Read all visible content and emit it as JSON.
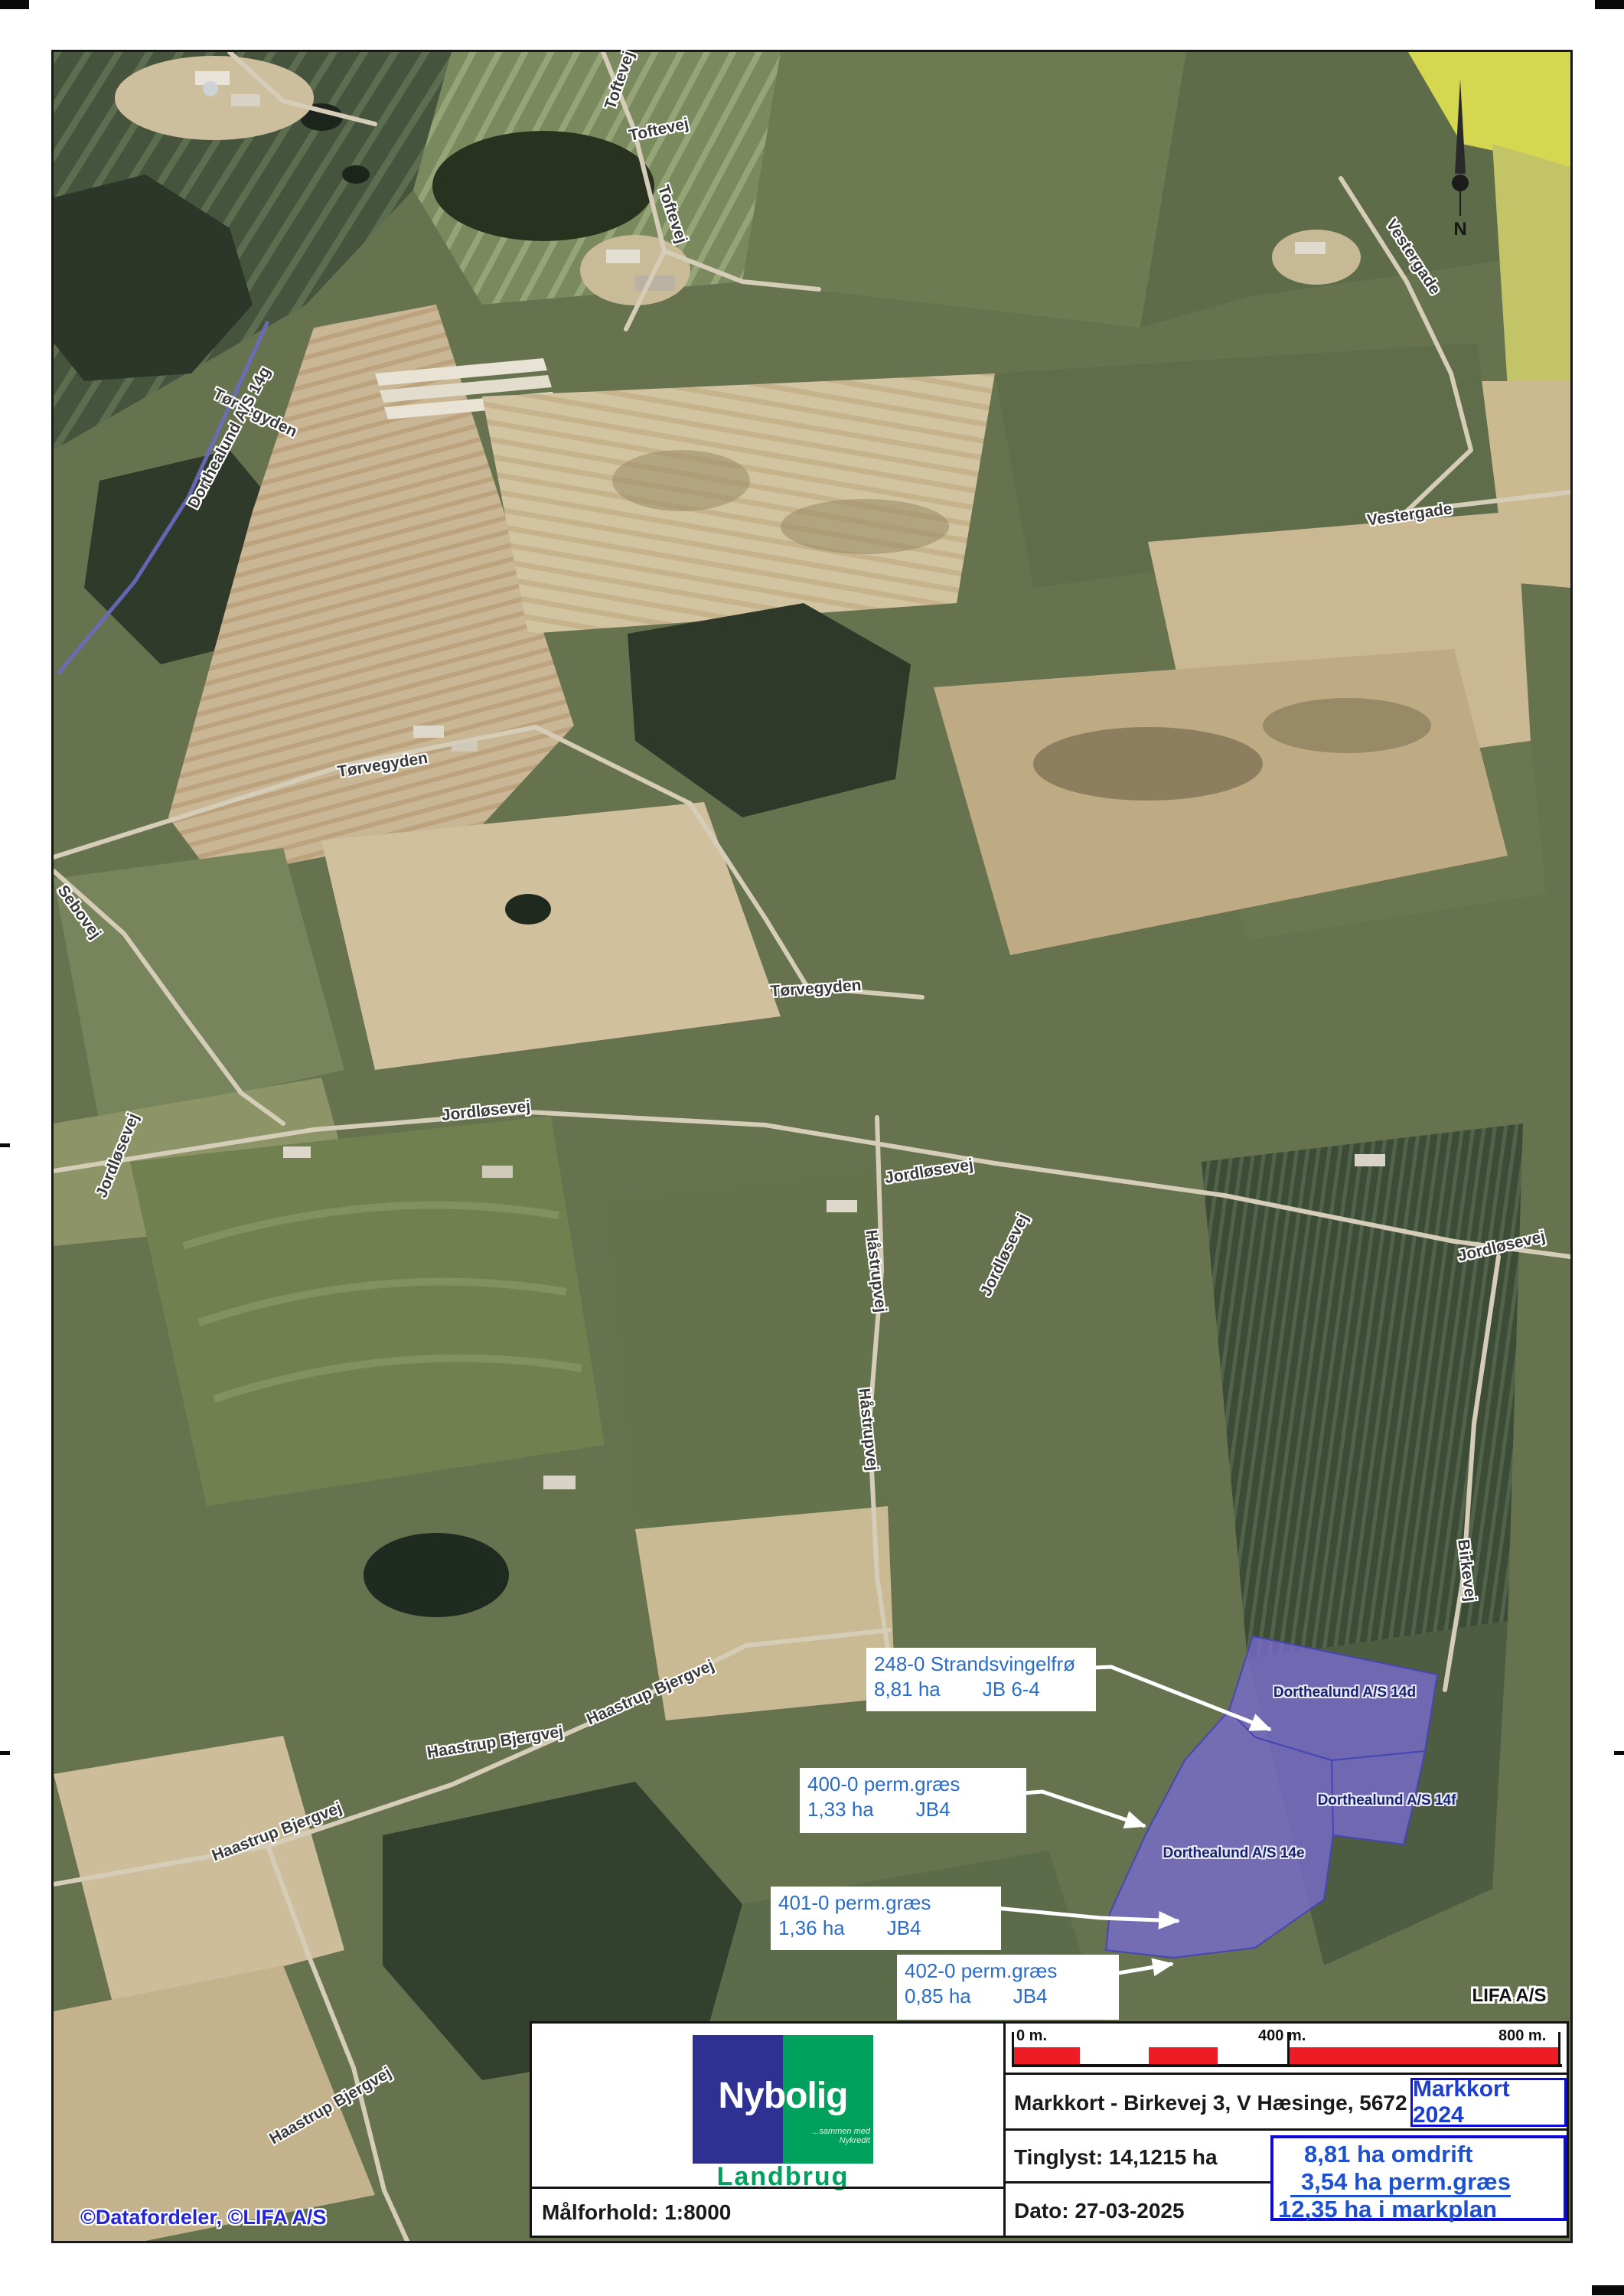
{
  "map": {
    "north_label": "N",
    "watermark": "©Datafordeler, ©LIFA A/S",
    "corner_label": "LIFA A/S",
    "road_labels": [
      {
        "text": "Toftevej"
      },
      {
        "text": "Toftevej"
      },
      {
        "text": "Toftevej"
      },
      {
        "text": "Tørvegyden"
      },
      {
        "text": "Dorthealund A/S 14g"
      },
      {
        "text": "Tørvegyden"
      },
      {
        "text": "Tørvegyden"
      },
      {
        "text": "Vestergade"
      },
      {
        "text": "Vestergade"
      },
      {
        "text": "Sebovej"
      },
      {
        "text": "Jordløsevej"
      },
      {
        "text": "Jordløsevej"
      },
      {
        "text": "Jordløsevej"
      },
      {
        "text": "Jordløsevej"
      },
      {
        "text": "Jordløsevej"
      },
      {
        "text": "Håstrupvej"
      },
      {
        "text": "Håstrupvej"
      },
      {
        "text": "Haastrup Bjergvej"
      },
      {
        "text": "Haastrup Bjergvej"
      },
      {
        "text": "Haastrup Bjergvej"
      },
      {
        "text": "Haastrup Bjergvej"
      },
      {
        "text": "Birkevej"
      }
    ],
    "parcel_labels": [
      {
        "text": "Dorthealund A/S 14d"
      },
      {
        "text": "Dorthealund A/S 14f"
      },
      {
        "text": "Dorthealund A/S 14e"
      }
    ],
    "annotations": [
      {
        "title": "248-0 Strandsvingelfrø",
        "area": "8,81 ha",
        "soil": "JB 6-4"
      },
      {
        "title": "400-0 perm.græs",
        "area": "1,33 ha",
        "soil": "JB4"
      },
      {
        "title": "401-0 perm.græs",
        "area": "1,36 ha",
        "soil": "JB4"
      },
      {
        "title": "402-0 perm.græs",
        "area": "0,85 ha",
        "soil": "JB4"
      }
    ]
  },
  "panel": {
    "scalebar": {
      "start": "0 m.",
      "mid": "400 m.",
      "end": "800 m."
    },
    "logo": {
      "brand": "Nybolig",
      "tagline": "...sammen med Nykredit",
      "division": "Landbrug"
    },
    "scale_text": "Målforhold: 1:8000",
    "title": "Markkort - Birkevej 3, V Hæsinge, 5672 B",
    "badge": "Markkort 2024",
    "tinglyst": "Tinglyst: 14,1215 ha",
    "date": "Dato: 27-03-2025",
    "summary": {
      "omdrift": "8,81 ha omdrift",
      "perm": "3,54 ha perm.græs",
      "markplan": "12,35 ha i markplan"
    }
  },
  "colors": {
    "parcel_purple": "#7a6cd0",
    "accent_blue": "#0c0cd6",
    "annotation_blue": "#2a6cc8",
    "scalebar_red": "#ee1c25",
    "logo_blue": "#2e3192",
    "logo_green": "#00a15d"
  }
}
